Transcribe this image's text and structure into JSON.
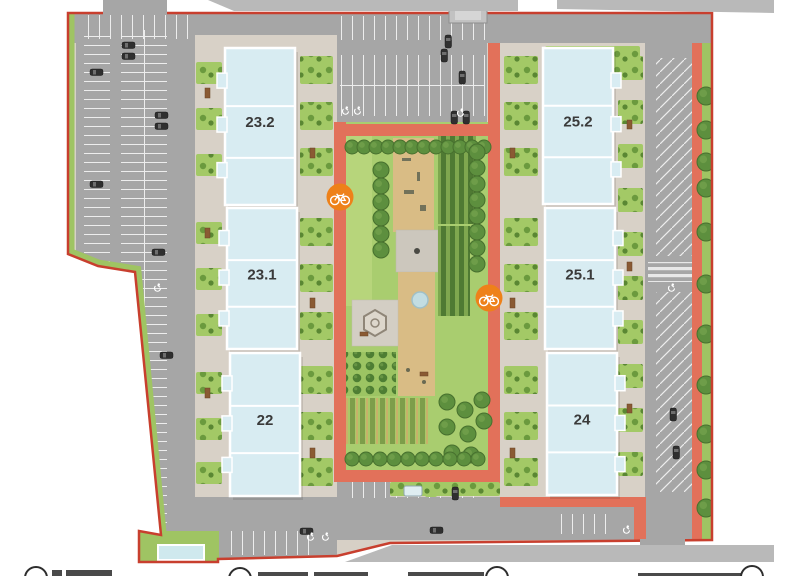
{
  "site_plan": {
    "type": "residential-masterplan",
    "colors": {
      "boundary": "#c83f2e",
      "coral_path": "#e2715a",
      "road": "#a6a6a6",
      "outside_road": "#b9b9b9",
      "pavement": "#d7d0c6",
      "lawn": "#a9cd6f",
      "tree": "#5d8f3e",
      "building_fill": "#d8ecf2",
      "bike_marker": "#ee8119",
      "parking_line": "#ededed"
    },
    "buildings": [
      {
        "label": "23.2",
        "x": 225,
        "y": 48,
        "w": 70,
        "h": 157,
        "tabs": "left"
      },
      {
        "label": "23.1",
        "x": 227,
        "y": 208,
        "w": 70,
        "h": 141,
        "tabs": "left"
      },
      {
        "label": "22",
        "x": 230,
        "y": 353,
        "w": 70,
        "h": 143,
        "tabs": "left"
      },
      {
        "label": "25.2",
        "x": 543,
        "y": 48,
        "w": 70,
        "h": 156,
        "tabs": "right"
      },
      {
        "label": "25.1",
        "x": 545,
        "y": 208,
        "w": 70,
        "h": 141,
        "tabs": "right"
      },
      {
        "label": "24",
        "x": 547,
        "y": 353,
        "w": 70,
        "h": 142,
        "tabs": "right"
      }
    ],
    "markers": {
      "bike": [
        {
          "x": 340,
          "y": 197
        },
        {
          "x": 489,
          "y": 298
        }
      ]
    },
    "legend": {
      "note_items_clipped_at_bottom_edge": true,
      "items": [
        {
          "icon": "circle-marker",
          "circle_x": 36,
          "circle_y": 578,
          "bars": [
            [
              52,
              570,
              10,
              6
            ],
            [
              66,
              570,
              46,
              6
            ]
          ]
        },
        {
          "icon": "circle-marker",
          "circle_x": 240,
          "circle_y": 579,
          "bars": [
            [
              258,
              572,
              50,
              4
            ],
            [
              314,
              572,
              54,
              4
            ]
          ]
        },
        {
          "icon": "circle-marker",
          "circle_x": 497,
          "circle_y": 578,
          "bars": [
            [
              408,
              572,
              76,
              4
            ]
          ]
        },
        {
          "icon": "circle-marker",
          "circle_x": 752,
          "circle_y": 577,
          "bars": [
            [
              638,
              573,
              104,
              3
            ]
          ]
        }
      ]
    },
    "decorations": {
      "trees": [
        [
          352,
          147,
          7
        ],
        [
          364,
          147,
          7
        ],
        [
          376,
          147,
          7
        ],
        [
          388,
          147,
          7
        ],
        [
          400,
          147,
          7
        ],
        [
          412,
          147,
          7
        ],
        [
          424,
          147,
          7
        ],
        [
          436,
          147,
          7
        ],
        [
          448,
          147,
          7
        ],
        [
          460,
          147,
          7
        ],
        [
          472,
          147,
          7
        ],
        [
          484,
          147,
          7
        ],
        [
          381,
          170,
          8
        ],
        [
          381,
          186,
          8
        ],
        [
          381,
          202,
          8
        ],
        [
          381,
          218,
          8
        ],
        [
          381,
          234,
          8
        ],
        [
          381,
          250,
          8
        ],
        [
          477,
          152,
          8
        ],
        [
          477,
          168,
          8
        ],
        [
          477,
          184,
          8
        ],
        [
          477,
          200,
          8
        ],
        [
          477,
          216,
          8
        ],
        [
          477,
          232,
          8
        ],
        [
          477,
          248,
          8
        ],
        [
          477,
          264,
          8
        ],
        [
          447,
          402,
          8
        ],
        [
          465,
          410,
          8
        ],
        [
          482,
          400,
          8
        ],
        [
          447,
          427,
          8
        ],
        [
          468,
          434,
          8
        ],
        [
          484,
          421,
          8
        ],
        [
          452,
          453,
          8
        ],
        [
          471,
          455,
          8
        ],
        [
          352,
          459,
          7
        ],
        [
          366,
          459,
          7
        ],
        [
          380,
          459,
          7
        ],
        [
          394,
          459,
          7
        ],
        [
          408,
          459,
          7
        ],
        [
          422,
          459,
          7
        ],
        [
          436,
          459,
          7
        ],
        [
          450,
          459,
          7
        ],
        [
          464,
          459,
          7
        ],
        [
          478,
          459,
          7
        ],
        [
          706,
          96,
          9
        ],
        [
          706,
          130,
          9
        ],
        [
          706,
          162,
          9
        ],
        [
          706,
          188,
          9
        ],
        [
          706,
          232,
          9
        ],
        [
          706,
          284,
          9
        ],
        [
          706,
          334,
          9
        ],
        [
          706,
          385,
          9
        ],
        [
          706,
          434,
          9
        ],
        [
          706,
          470,
          9
        ],
        [
          706,
          508,
          9
        ]
      ],
      "cars": [
        [
          122,
          42,
          "h"
        ],
        [
          122,
          53,
          "h"
        ],
        [
          90,
          69,
          "h"
        ],
        [
          155,
          112,
          "h"
        ],
        [
          155,
          123,
          "h"
        ],
        [
          90,
          181,
          "h"
        ],
        [
          90,
          277,
          "h"
        ],
        [
          152,
          249,
          "h"
        ],
        [
          160,
          352,
          "h"
        ],
        [
          92,
          430,
          "h"
        ],
        [
          441,
          49,
          "v"
        ],
        [
          459,
          71,
          "v"
        ],
        [
          451,
          111,
          "v"
        ],
        [
          463,
          111,
          "v"
        ],
        [
          445,
          35,
          "v"
        ],
        [
          670,
          408,
          "v"
        ],
        [
          673,
          446,
          "v"
        ],
        [
          452,
          487,
          "v"
        ],
        [
          300,
          528,
          "h"
        ],
        [
          430,
          527,
          "h"
        ]
      ],
      "bush_patches": [
        [
          196,
          62,
          26,
          22
        ],
        [
          196,
          108,
          26,
          22
        ],
        [
          196,
          154,
          26,
          22
        ],
        [
          196,
          222,
          26,
          22
        ],
        [
          196,
          268,
          26,
          22
        ],
        [
          196,
          314,
          26,
          22
        ],
        [
          196,
          372,
          26,
          22
        ],
        [
          196,
          418,
          26,
          22
        ],
        [
          196,
          462,
          26,
          22
        ],
        [
          300,
          56,
          33,
          28
        ],
        [
          300,
          102,
          33,
          28
        ],
        [
          300,
          148,
          33,
          28
        ],
        [
          300,
          218,
          33,
          28
        ],
        [
          300,
          264,
          33,
          28
        ],
        [
          300,
          312,
          33,
          28
        ],
        [
          300,
          366,
          33,
          28
        ],
        [
          300,
          412,
          33,
          28
        ],
        [
          300,
          458,
          33,
          28
        ],
        [
          504,
          56,
          34,
          28
        ],
        [
          504,
          102,
          34,
          28
        ],
        [
          504,
          148,
          34,
          28
        ],
        [
          504,
          218,
          34,
          28
        ],
        [
          504,
          264,
          34,
          28
        ],
        [
          504,
          312,
          34,
          28
        ],
        [
          504,
          366,
          34,
          28
        ],
        [
          504,
          412,
          34,
          28
        ],
        [
          504,
          458,
          34,
          28
        ],
        [
          618,
          56,
          25,
          24
        ],
        [
          618,
          100,
          25,
          24
        ],
        [
          618,
          144,
          25,
          24
        ],
        [
          618,
          188,
          25,
          24
        ],
        [
          618,
          232,
          25,
          24
        ],
        [
          618,
          276,
          25,
          24
        ],
        [
          618,
          320,
          25,
          24
        ],
        [
          618,
          364,
          25,
          24
        ],
        [
          618,
          408,
          25,
          24
        ],
        [
          618,
          452,
          25,
          24
        ],
        [
          545,
          46,
          95,
          28
        ],
        [
          390,
          482,
          110,
          14
        ]
      ],
      "benches": [
        [
          205,
          88,
          5,
          10
        ],
        [
          205,
          228,
          5,
          10
        ],
        [
          205,
          388,
          5,
          10
        ],
        [
          310,
          148,
          5,
          10
        ],
        [
          310,
          298,
          5,
          10
        ],
        [
          310,
          448,
          5,
          10
        ],
        [
          510,
          148,
          5,
          10
        ],
        [
          510,
          298,
          5,
          10
        ],
        [
          510,
          448,
          5,
          10
        ],
        [
          627,
          120,
          5,
          9
        ],
        [
          627,
          262,
          5,
          9
        ],
        [
          627,
          404,
          5,
          9
        ],
        [
          360,
          332,
          8,
          4
        ],
        [
          420,
          372,
          8,
          4
        ]
      ],
      "accessible_parking_icons": [
        [
          346,
          110
        ],
        [
          358,
          110
        ],
        [
          461,
          112
        ],
        [
          158,
          287
        ],
        [
          672,
          287
        ],
        [
          627,
          529
        ],
        [
          311,
          536
        ],
        [
          326,
          536
        ]
      ]
    }
  }
}
